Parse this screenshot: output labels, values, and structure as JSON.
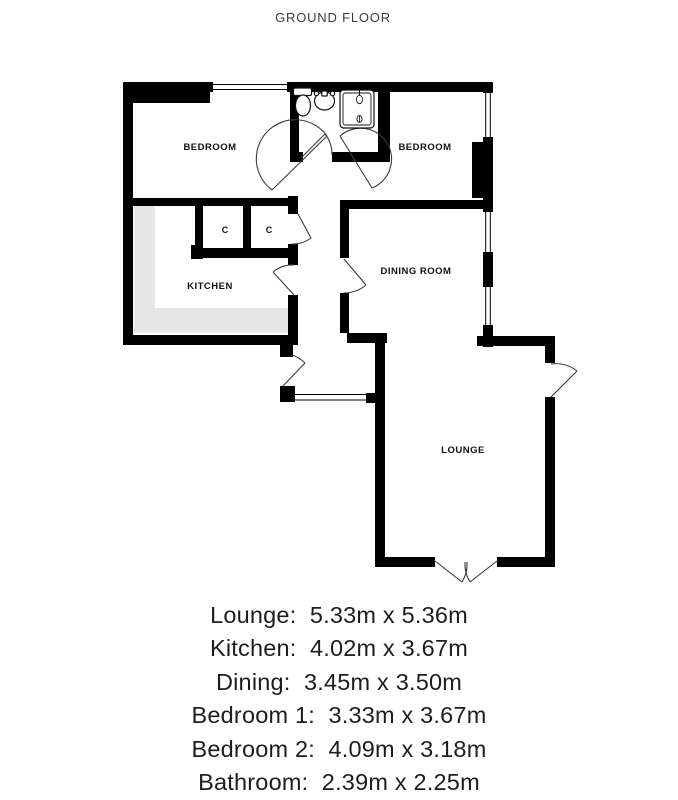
{
  "page_title": "GROUND FLOOR",
  "plan": {
    "room_labels": {
      "bedroom_1": "BEDROOM",
      "bedroom_2": "BEDROOM",
      "kitchen": "KITCHEN",
      "dining_room": "DINING ROOM",
      "lounge": "LOUNGE",
      "cupboard_1": "C",
      "cupboard_2": "C"
    },
    "fixtures": [
      "toilet-icon",
      "sink-icon",
      "shower-icon"
    ],
    "colors": {
      "wall": "#000000",
      "counter": "#e7e7e7",
      "door_arc": "#3a3a3a",
      "label_text": "#111111"
    }
  },
  "dimensions_list": [
    "Lounge:  5.33m x 5.36m",
    "Kitchen:  4.02m x 3.67m",
    "Dining:  3.45m x 3.50m",
    "Bedroom 1:  3.33m x 3.67m",
    "Bedroom 2:  4.09m x 3.18m",
    "Bathroom:  2.39m x 2.25m"
  ]
}
